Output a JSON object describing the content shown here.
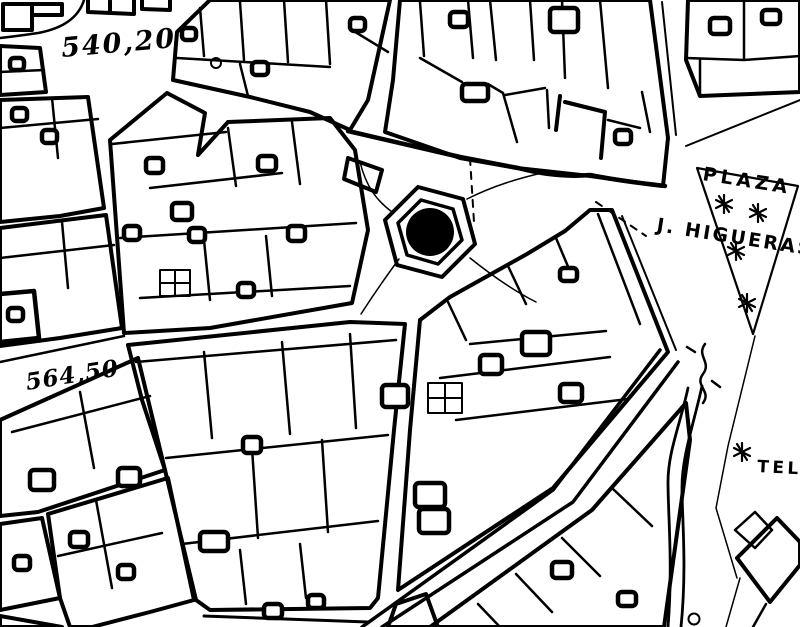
{
  "map": {
    "type": "black-and-white cadastral city map",
    "labels": {
      "elevation_top_left": "540,20",
      "elevation_mid_left": "564,50",
      "plaza_line1": "PLAZA",
      "plaza_line2": "J. HIGUERAS",
      "street_partial_right": "TEL"
    },
    "symbols": {
      "fountain": "hexagonal fountain with solid black center",
      "tree": "asterisk tree symbol",
      "trees_in_plaza": 4,
      "tree_near_tel": 1
    },
    "colors": {
      "ink": "#000000",
      "paper": "#ffffff"
    }
  }
}
